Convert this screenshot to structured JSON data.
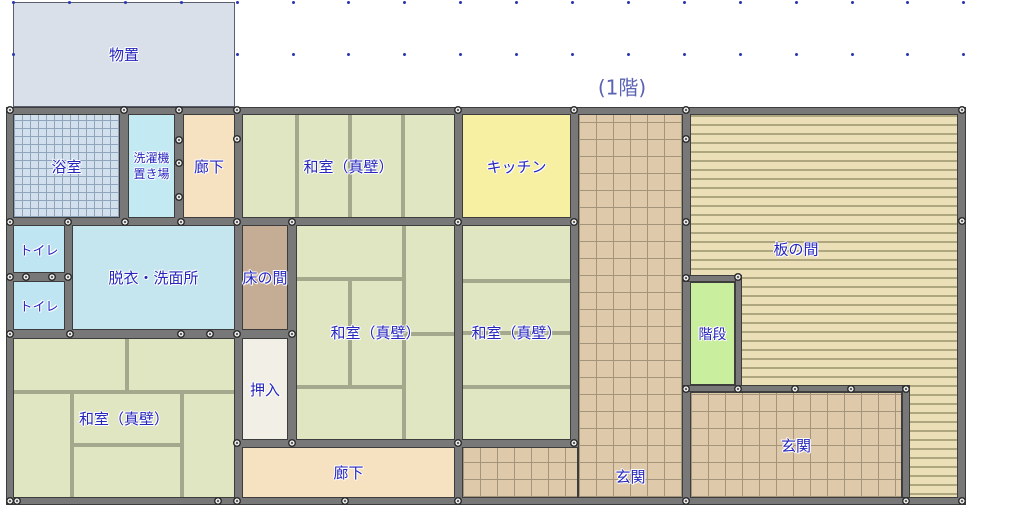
{
  "floor_label": "(1階)",
  "rooms": [
    {
      "id": "storage",
      "label": "物置",
      "color": "#d9e0ea"
    },
    {
      "id": "bath",
      "label": "浴室",
      "color": "#d2e0ee"
    },
    {
      "id": "laundry",
      "label": "洗濯機\n置き場",
      "color": "#c3e9f2"
    },
    {
      "id": "corridor-top",
      "label": "廊下",
      "color": "#f6e2c0"
    },
    {
      "id": "washitsu-top",
      "label": "和室（真壁）",
      "color": "#e0e6c2"
    },
    {
      "id": "kitchen",
      "label": "キッチン",
      "color": "#f7f0a3"
    },
    {
      "id": "toilet-upper",
      "label": "トイレ",
      "color": "#c0e5f2"
    },
    {
      "id": "toilet-lower",
      "label": "トイレ",
      "color": "#c0e5f2"
    },
    {
      "id": "washroom",
      "label": "脱衣・洗面所",
      "color": "#c5e6ef"
    },
    {
      "id": "tokonoma",
      "label": "床の間",
      "color": "#c4ac95"
    },
    {
      "id": "washitsu-middle",
      "label": "和室（真壁）",
      "color": "#e0e6c2"
    },
    {
      "id": "washitsu-right",
      "label": "和室（真壁）",
      "color": "#e0e6c2"
    },
    {
      "id": "oshiire",
      "label": "押入",
      "color": "#f2efe6"
    },
    {
      "id": "washitsu-bottom-left",
      "label": "和室（真壁）",
      "color": "#e0e6c2"
    },
    {
      "id": "corridor-bottom",
      "label": "廊下",
      "color": "#f6e2c0"
    },
    {
      "id": "genkan-hall",
      "label": "玄関",
      "color": "#dfc9ab"
    },
    {
      "id": "itanoma",
      "label": "板の間",
      "color": "#eadfb6"
    },
    {
      "id": "stairs",
      "label": "階段",
      "color": "#c9ee9d"
    },
    {
      "id": "genkan-entrance",
      "label": "玄関",
      "color": "#dfc9ab"
    }
  ],
  "colors": {
    "wall_fill": "#787878",
    "wall_edge": "#3d3d3d",
    "joint_marker": "#e5e5e5",
    "room_label_text": "#2626bd",
    "floor_label_text": "#5b63b3",
    "grid_dot": "#2b35b0",
    "tatami_divider": "#a4a88c",
    "bath_tile_line": "#8fa6bd",
    "genkan_tile_line": "#a5947c",
    "itanoma_stripe": "#ada67e"
  }
}
